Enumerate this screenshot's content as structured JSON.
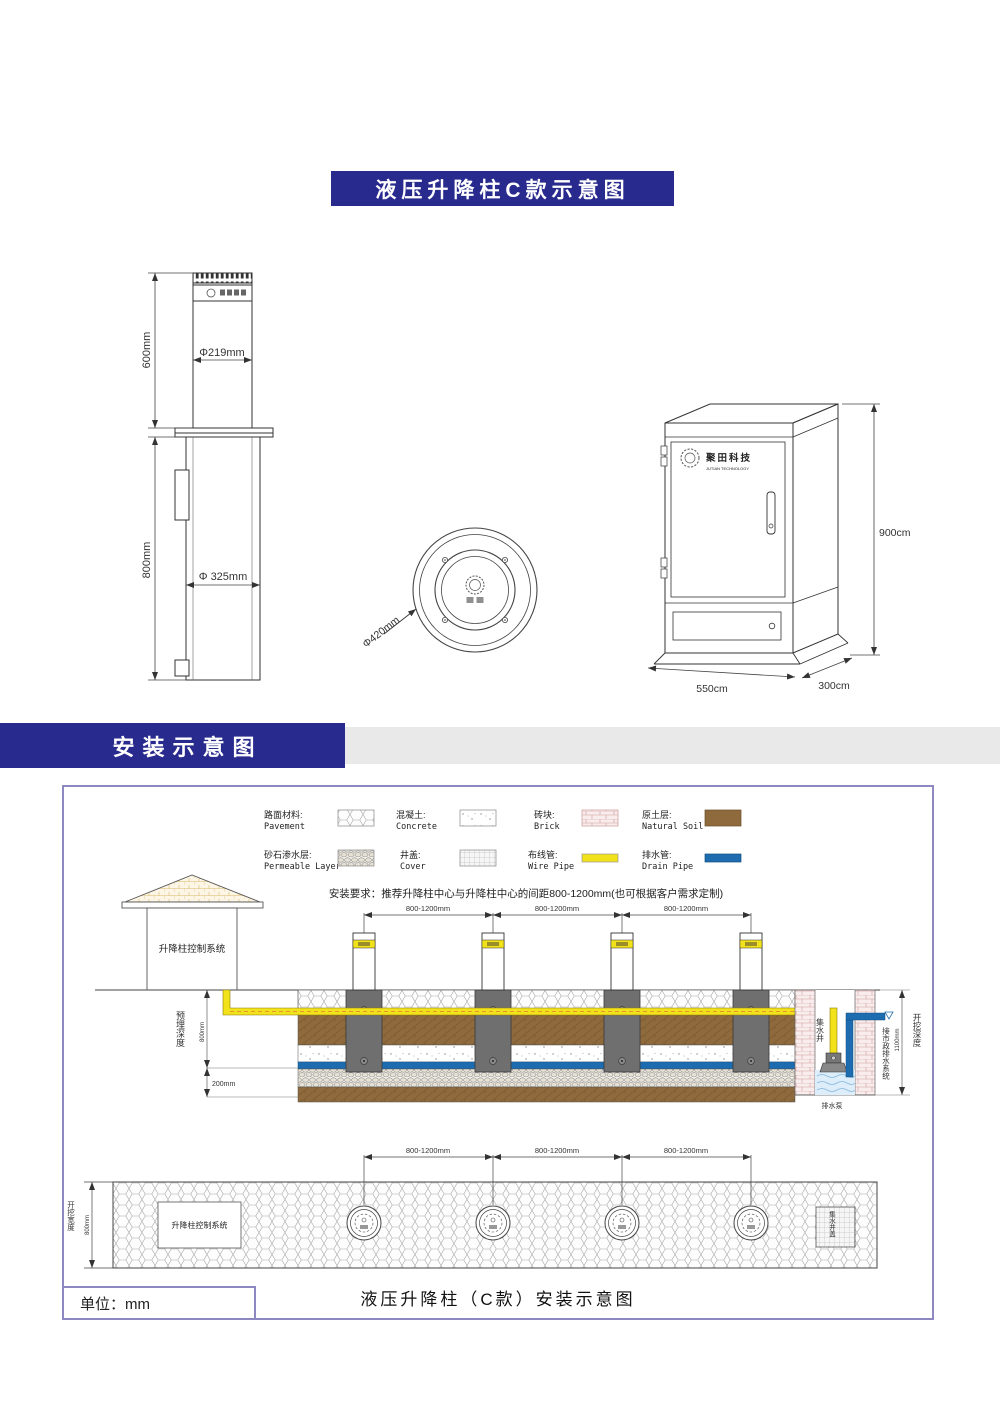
{
  "product_section": {
    "title": "液压升降柱C款示意图",
    "side_view": {
      "height_above": "600mm",
      "dia_above": "Φ219mm",
      "height_below": "800mm",
      "dia_below": "Φ 325mm"
    },
    "top_view": {
      "dia": "Φ420mm"
    },
    "cabinet": {
      "logo_cn": "聚田科技",
      "logo_en": "JUTIAN TECHNOLOGY",
      "height": "900cm",
      "width": "550cm",
      "depth": "300cm"
    }
  },
  "install_section": {
    "banner": "安装示意图",
    "legend": {
      "items": [
        {
          "cn": "路面材料:",
          "en": "Pavement",
          "swatch": "pavement-hex"
        },
        {
          "cn": "混凝土:",
          "en": "Concrete",
          "swatch": "concrete-dots"
        },
        {
          "cn": "砖块:",
          "en": "Brick",
          "swatch": "brick"
        },
        {
          "cn": "原土层:",
          "en": "Natural Soil",
          "swatch": "soil-brown"
        },
        {
          "cn": "砂石渗水层:",
          "en": "Permeable Layer",
          "swatch": "cobble"
        },
        {
          "cn": "井盖:",
          "en": "Cover",
          "swatch": "grid"
        },
        {
          "cn": "布线管:",
          "en": "Wire Pipe",
          "swatch": "yellow-bar"
        },
        {
          "cn": "排水管:",
          "en": "Drain Pipe",
          "swatch": "blue-bar"
        }
      ]
    },
    "requirement": "安装要求：推荐升降柱中心与升降柱中心的间距800-1200mm(也可根据客户需求定制)",
    "spacing": "800-1200mm",
    "control_room": "升降柱控制系统",
    "embed_depth_label": "预埋深度",
    "embed_depth_value": "800mm",
    "base_layer_value": "200mm",
    "well_label": "集水井",
    "municipal_drain_label": "接市政排水系统",
    "pump_label": "排水泵",
    "excavation_depth_label": "开挖深度",
    "excavation_depth_value": "1100mm",
    "plan": {
      "control_room": "升降柱控制系统",
      "excavation_width_label": "开挖宽度",
      "excavation_width_value": "800mm",
      "well_cover_label": "集水井盖"
    },
    "caption": "液压升降柱（C款）安装示意图",
    "unit": "单位：mm"
  },
  "colors": {
    "banner_blue": "#282a8e",
    "soil_brown": "#8e6a3c",
    "wire_pipe_yellow": "#f2e21c",
    "drain_pipe_blue": "#1e6cb0",
    "panel_border": "#8d89c0"
  }
}
